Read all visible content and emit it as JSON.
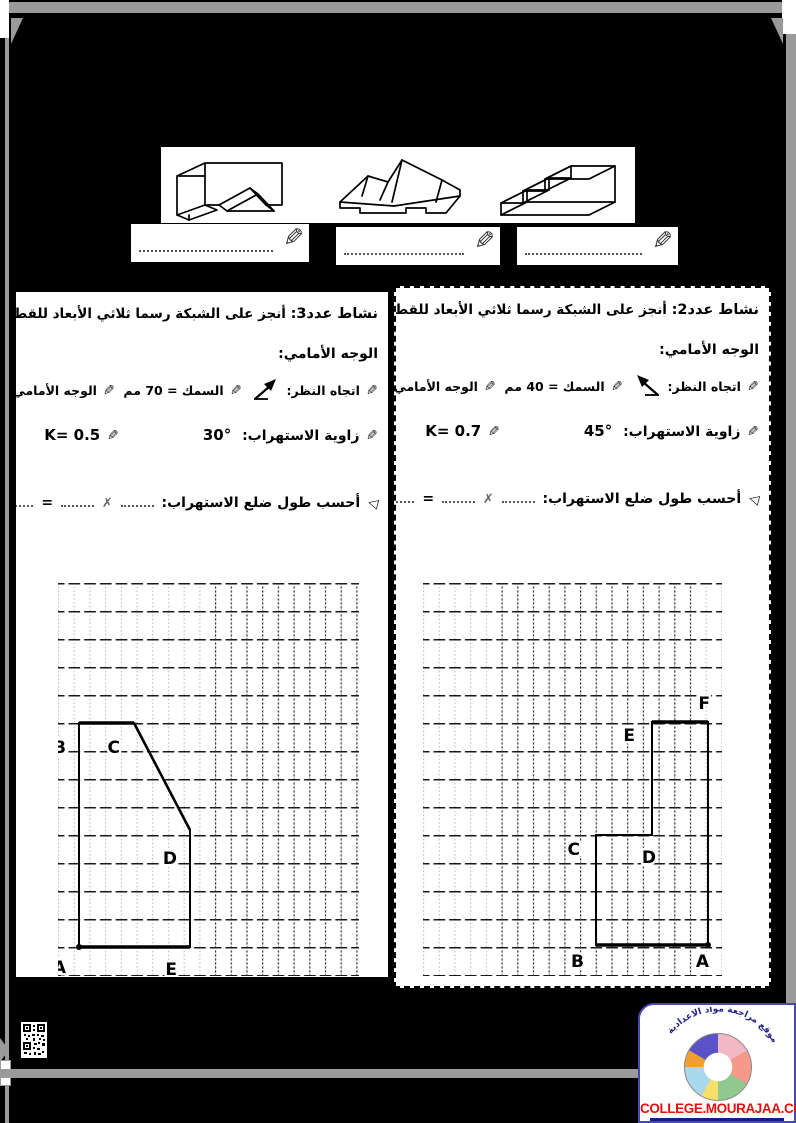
{
  "icons": {
    "pencil": "✎",
    "arrow_bullet": "◁"
  },
  "activity2": {
    "number_label": "نشاط عدد2:",
    "title": "أنجز على الشبكة رسما ثلاثي الأبعاد للقطعة انطلاقا من",
    "title2": "الوجه الأمامي:",
    "view_label": "اتجاه النظر:",
    "thickness": "السمك = 40 مم",
    "face_label": "الوجه الأمامي:",
    "face_value": "ABCDEF",
    "angle_label": "زاوية الاستهراب:",
    "angle": "45°",
    "k": "K= 0.7",
    "compute": "أحسب طول ضلع الاستهراب:",
    "times": "✗",
    "eq": "=",
    "vertices": {
      "A": "A",
      "B": "B",
      "C": "C",
      "D": "D",
      "E": "E",
      "F": "F"
    }
  },
  "activity3": {
    "number_label": "نشاط عدد3:",
    "title": "أنجز على الشبكة رسما ثلاثي الأبعاد للقطعة انطلاقا من",
    "title2": "الوجه الأمامي:",
    "view_label": "اتجاه النظر:",
    "thickness": "السمك = 70 مم",
    "face_label": "الوجه الأمامي:",
    "face_value": "ABCDE",
    "angle_label": "زاوية الاستهراب:",
    "angle": "30°",
    "k": "K= 0.5",
    "compute": "أحسب طول ضلع الاستهراب:",
    "times": "✗",
    "eq": "=",
    "vertices": {
      "A": "A",
      "B": "B",
      "C": "C",
      "D": "D",
      "E": "E"
    }
  },
  "footer": {
    "site": "COLLEGE.MOURAJAA.COM",
    "tagline": "موقع مراجعة مواد الاعدادية"
  },
  "colors": {
    "frame_gray": "#9a9a9a",
    "site_red": "#e31010",
    "underline_navy": "#1a1a8c"
  }
}
